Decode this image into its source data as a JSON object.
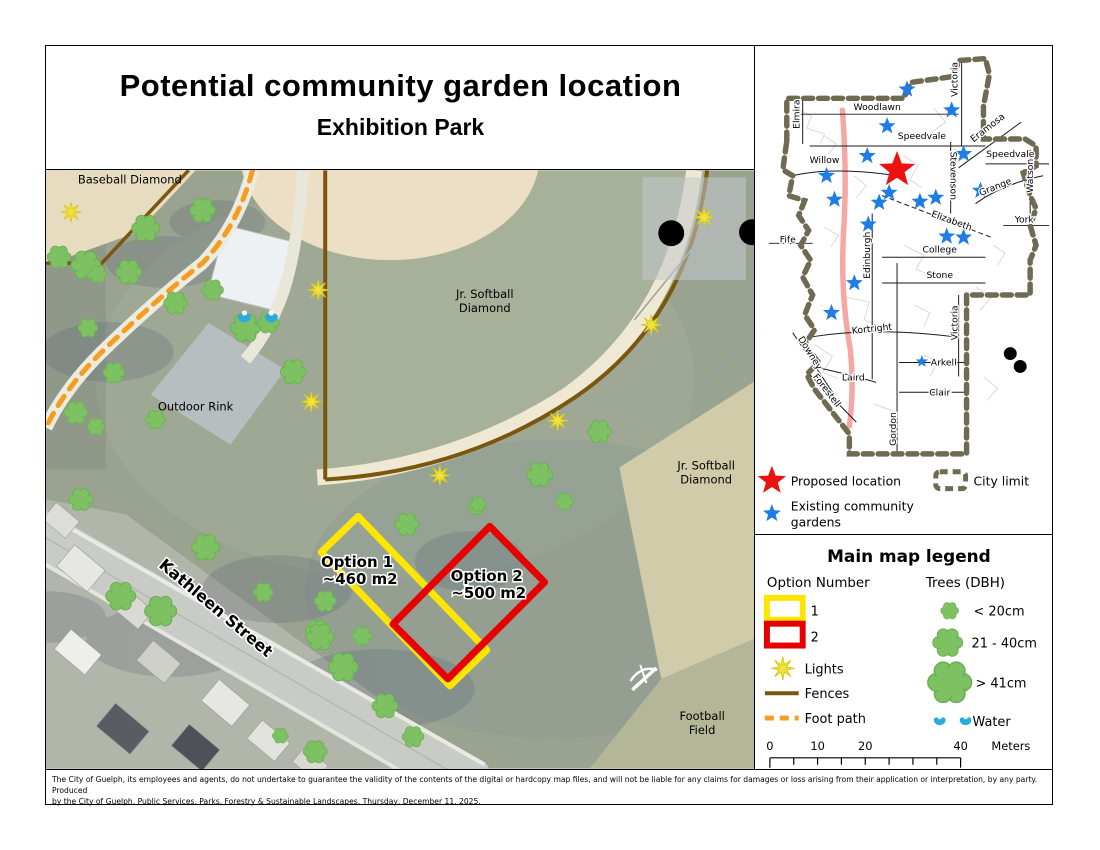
{
  "page": {
    "title": "Potential community garden location",
    "subtitle": "Exhibition Park"
  },
  "main_map": {
    "labels": {
      "baseball_diamond": "Baseball Diamond",
      "jr_softball_line1": "Jr. Softball",
      "jr_softball_line2": "Diamond",
      "outdoor_rink": "Outdoor Rink",
      "football_line1": "Football",
      "football_line2": "Field",
      "kathleen_street": "Kathleen Street",
      "option1_name": "Option 1",
      "option1_area": "~460 m2",
      "option2_name": "Option 2",
      "option2_area": "~500 m2"
    }
  },
  "inset": {
    "streets": [
      "Elmira",
      "Woodlawn",
      "Victoria",
      "Speedvale",
      "Eramosa",
      "Speedvale",
      "Willow",
      "Stevenson",
      "Grange",
      "Watson",
      "Elizabeth",
      "York",
      "Fife",
      "Edinburgh",
      "College",
      "Stone",
      "Kortright",
      "Victoria",
      "Downey",
      "Arkell",
      "Laird",
      "Clair",
      "Forestell",
      "Gordon"
    ],
    "legend": {
      "proposed": "Proposed location",
      "existing_line1": "Existing community",
      "existing_line2": "gardens",
      "city_limit": "City limit"
    }
  },
  "legend": {
    "title": "Main map legend",
    "options_header": "Option Number",
    "option1_label": "1",
    "option2_label": "2",
    "lights": "Lights",
    "fences": "Fences",
    "foot_path": "Foot path",
    "trees_header": "Trees (DBH)",
    "tree_small": "< 20cm",
    "tree_medium": "21 - 40cm",
    "tree_large": "> 41cm",
    "water": "Water",
    "scale_bar": {
      "t0": "0",
      "t1": "10",
      "t2": "20",
      "t3": "40",
      "unit": "Meters"
    }
  },
  "disclaimer": {
    "line1": "The City of Guelph, its employees and agents, do not undertake to guarantee the validity of the contents of the digital or hardcopy map files, and will not be liable for any claims for damages or loss arising from their application or interpretation, by any party. Produced",
    "line2": "by the City of Guelph, Public Services, Parks, Forestry & Sustainable Landscapes, Thursday, December 11, 2025."
  },
  "colors": {
    "proposed_red": "#ee1111",
    "garden_blue": "#1e7ce6",
    "option_yellow": "#ffe600",
    "option_red": "#e60000",
    "fence_brown": "#7a560e",
    "footpath_orange": "#f59d1e",
    "tree_green": "#7dc163",
    "water_blue": "#29abe2",
    "light_yellow": "#f2e33c",
    "city_limit_olive": "#6f6a52",
    "highway_pink": "#f6a6a3"
  }
}
